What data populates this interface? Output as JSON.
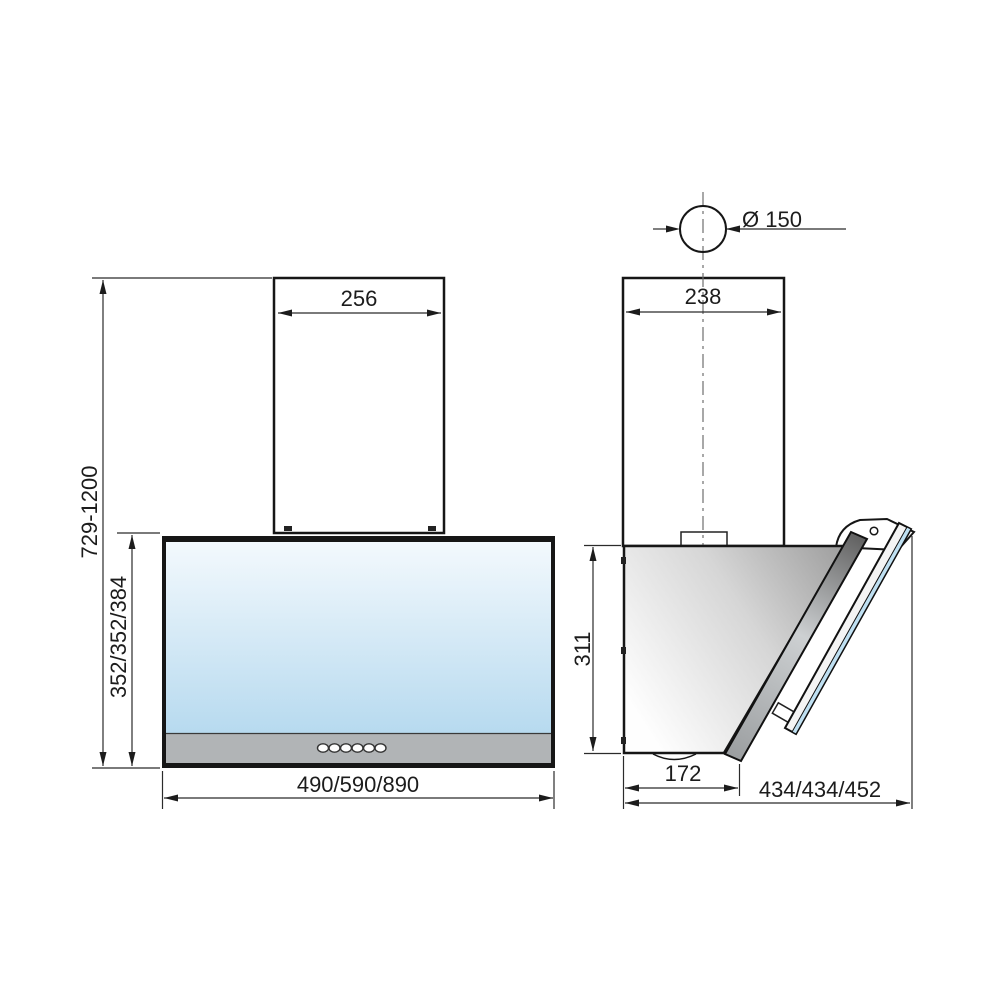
{
  "drawing": {
    "subject": "kitchen-hood-dimension-drawing",
    "front_view": {
      "chimney_width": "256",
      "overall_height": "729-1200",
      "body_height": "352/352/384",
      "body_width": "490/590/890"
    },
    "side_view": {
      "duct_diameter": "Ø 150",
      "chimney_depth": "238",
      "body_height": "311",
      "body_bottom_depth": "172",
      "overall_depth": "434/434/452"
    },
    "controls": {
      "button_count": 6
    }
  },
  "colors": {
    "line": "#161616",
    "chimney_top": "#fbfbfb",
    "chimney_bottom": "#a7a7a7",
    "glass_top": "#f3f9fd",
    "glass_bottom": "#b7daef",
    "control_strip": "#b1b4b6",
    "side_body_light": "#fefefe",
    "side_body_dark": "#9e9e9e",
    "glass_edge_blue": "#bfe0f2"
  }
}
